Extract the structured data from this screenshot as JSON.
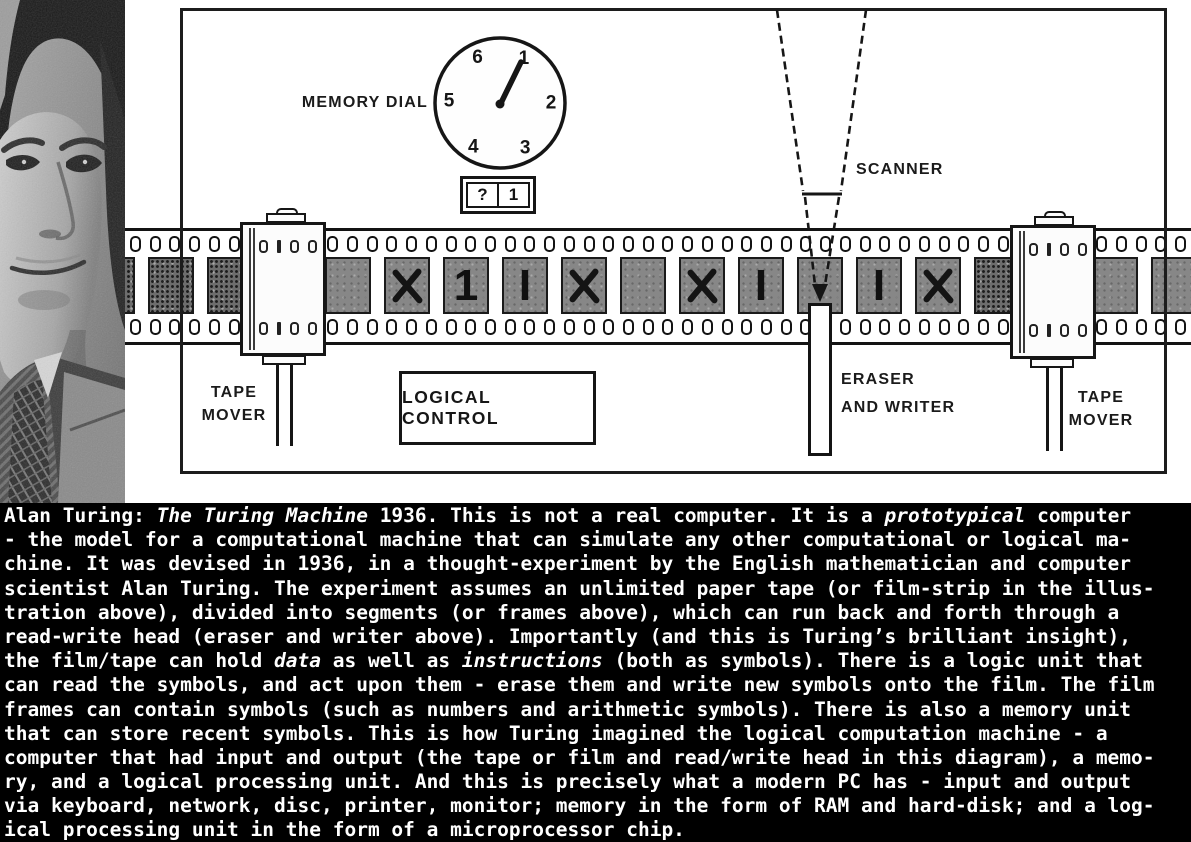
{
  "diagram": {
    "memory_dial": {
      "label": "MEMORY DIAL",
      "numbers": [
        "1",
        "2",
        "3",
        "4",
        "5",
        "6"
      ],
      "pointer": "1",
      "cells": [
        "?",
        "1"
      ]
    },
    "scanner": {
      "label": "SCANNER"
    },
    "tape_mover_left": {
      "line1": "TAPE",
      "line2": "MOVER"
    },
    "tape_mover_right": {
      "line1": "TAPE",
      "line2": "MOVER"
    },
    "eraser_writer": {
      "line1": "ERASER",
      "line2": "AND WRITER"
    },
    "logical_control": {
      "label": "LOGICAL CONTROL"
    },
    "film": {
      "frames": [
        "noise",
        "noise",
        "noise",
        "blank",
        "blank",
        "X",
        "1",
        "I",
        "X",
        "blank",
        "X",
        "I",
        "blank",
        "I",
        "X",
        "noise",
        "blank",
        "blank",
        "blank"
      ]
    },
    "colors": {
      "ink": "#161616",
      "frame_gray": "#878787",
      "noise_gray": "#6d6d6d"
    }
  },
  "caption": {
    "bg": "#000000",
    "fg": "#ffffff",
    "lines": [
      [
        {
          "t": "Alan Turing: "
        },
        {
          "t": "The Turing Machine",
          "i": true
        },
        {
          "t": " 1936. This is not a real computer. It is a "
        },
        {
          "t": "prototypical",
          "i": true
        },
        {
          "t": " computer"
        }
      ],
      [
        {
          "t": "- the model for a computational machine that can simulate any other computational or logical ma-"
        }
      ],
      [
        {
          "t": "chine. It was devised in 1936, in a thought-experiment by the English mathematician and computer"
        }
      ],
      [
        {
          "t": "scientist Alan Turing. The experiment assumes an unlimited paper tape (or film-strip in the illus-"
        }
      ],
      [
        {
          "t": "tration above), divided into segments (or frames above), which can run back and forth through a"
        }
      ],
      [
        {
          "t": "read-write head (eraser and writer above). Importantly (and this is Turing’s brilliant insight),"
        }
      ],
      [
        {
          "t": "the film/tape can hold "
        },
        {
          "t": "data",
          "i": true
        },
        {
          "t": " as well as "
        },
        {
          "t": "instructions",
          "i": true
        },
        {
          "t": " (both as symbols). There is a logic unit that"
        }
      ],
      [
        {
          "t": "can read the symbols, and act upon them - erase them and write new symbols onto the film. The film"
        }
      ],
      [
        {
          "t": "frames can contain symbols (such as numbers and arithmetic symbols). There is also a memory unit"
        }
      ],
      [
        {
          "t": "that can store recent symbols. This is how Turing imagined the logical computation machine - a"
        }
      ],
      [
        {
          "t": "computer that had input and output (the tape or film and read/write head in this diagram), a memo-"
        }
      ],
      [
        {
          "t": "ry, and a logical processing unit. And this is precisely what a modern PC has - input and output"
        }
      ],
      [
        {
          "t": "via keyboard, network, disc, printer, monitor; memory in the form of RAM and hard-disk; and a log-"
        }
      ],
      [
        {
          "t": "ical processing unit in the form of a microprocessor chip."
        }
      ]
    ]
  }
}
